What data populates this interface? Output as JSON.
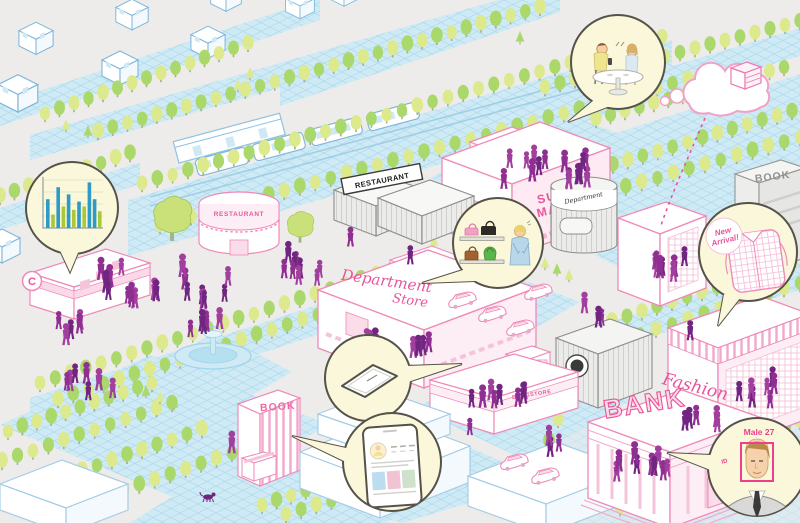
{
  "illustration": {
    "kind": "isometric-city-retail-analytics-scene",
    "background_color": "#edecea"
  },
  "colors": {
    "pink_accent": "#e8559a",
    "pink_outline": "#ef8ab8",
    "blue_outline": "#7fb7dc",
    "grid_block_blue": "#cfeaf5",
    "people_purple_1": "#8e2f91",
    "people_purple_2": "#702580",
    "people_purple_3": "#a13f9e",
    "tree_green": "#abd86b",
    "tree_yellow_green": "#dce98c",
    "bubble_fill": "#faf7da",
    "bubble_outline": "#55524a",
    "bar_blue": "#2e9bc6",
    "bar_green": "#a9c93a"
  },
  "buildings": {
    "convenience_store": {
      "logo": "C"
    },
    "restaurant_round": {
      "sign": "RESTAURANT"
    },
    "restaurant_gray": {
      "sign": "RESTAURANT"
    },
    "supermarket": {
      "sign_line1": "SUPER",
      "sign_line2": "MARKET"
    },
    "department_store": {
      "sign_line1": "Department",
      "sign_line2": "Store"
    },
    "department_tower": {
      "sign": "Department"
    },
    "book_store_gray": {
      "sign": "BOOK"
    },
    "book_store_pink": {
      "sign": "BOOK"
    },
    "fashion_store": {
      "sign": "Fashion"
    },
    "bank": {
      "sign": "BANK"
    },
    "drugstore": {
      "sign": "DRUGSTORE"
    }
  },
  "callouts": {
    "sales_chart_bubble": {
      "icon": "bar-chart"
    },
    "cafe_bubble": {
      "icon": "two-people-at-cafe-table"
    },
    "handbag_bubble": {
      "icon": "handbag-shelves-with-clerk"
    },
    "new_arrival_bubble": {
      "badge_line1": "New",
      "badge_line2": "Arrival!",
      "icon": "checkered-shirt"
    },
    "tablet_bubble": {
      "icon": "tablet-device"
    },
    "smartphone_bubble": {
      "icon": "smartphone-profile-screen"
    },
    "face_recognition_bubble": {
      "label": "Male 27",
      "tag": "ID",
      "icon": "face-detection-frame"
    },
    "cloud": {
      "icon": "cloud-data-server"
    }
  },
  "chart_data": {
    "type": "bar",
    "title": "",
    "xlabel": "",
    "ylabel": "",
    "categories": [
      "",
      "",
      "",
      "",
      "",
      "",
      "",
      "",
      "",
      "",
      ""
    ],
    "values": [
      60,
      28,
      85,
      45,
      70,
      38,
      55,
      45,
      95,
      60,
      35
    ],
    "bar_colors": [
      "#2e9bc6",
      "#a9c93a",
      "#2e9bc6",
      "#a9c93a",
      "#2e9bc6",
      "#a9c93a",
      "#2e9bc6",
      "#a9c93a",
      "#2e9bc6",
      "#2e9bc6",
      "#a9c93a"
    ],
    "ylim": [
      0,
      100
    ],
    "grid": true,
    "legend": "none"
  }
}
